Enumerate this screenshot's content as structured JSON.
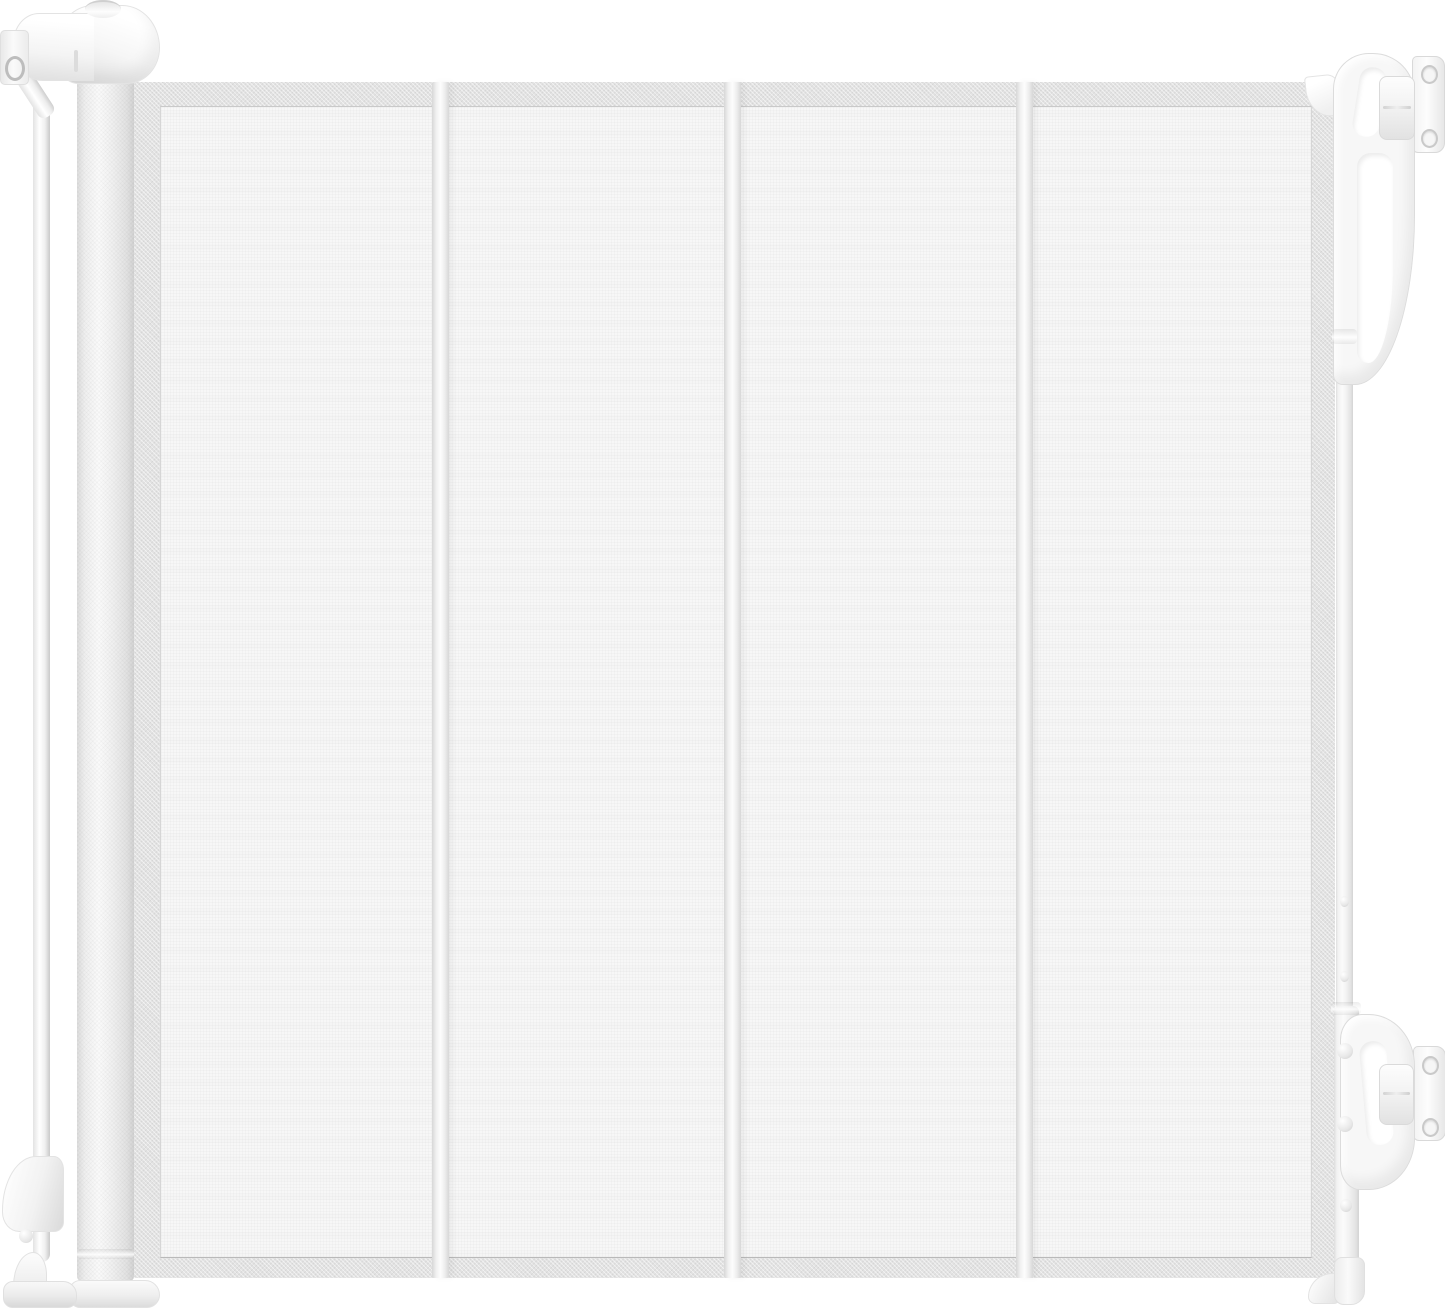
{
  "image": {
    "type": "product-photo",
    "subject": "white retractable mesh baby/pet safety gate, extended",
    "width_px": 1445,
    "height_px": 1309
  },
  "palette": {
    "background": "#ffffff",
    "mesh_fill": "#f7f7f7",
    "mesh_band": "#e2e2e2",
    "seam_light": "#fdfdfd",
    "seam_dark": "#d7d7d7",
    "hardware_white": "#fbfbfb",
    "hardware_mid": "#efefef",
    "hardware_shadow": "#d8d8d8",
    "outline": "#e0e0e0"
  },
  "components": {
    "mesh_panel": "retractable woven mesh screen with darker border band",
    "mesh_seam_count": 3,
    "roller_post": "spring-loaded roller housing with textured surface",
    "roller_cap": "rounded ratchet cap with oval top knob",
    "wall_clamp": "upper clamp block with screw hole",
    "tension_pole": "thin vertical tension pole",
    "pole_bracket": "lower pole wedge bracket with release knob",
    "pole_foot": "floor foot with base plate",
    "latch_bar": "vertical latch bar with screw bosses",
    "top_latch_handle": "upper carabiner-style locking handle",
    "bottom_latch_handle": "lower D-shaped locking handle",
    "wall_bracket_count": 2,
    "wall_bracket": "wall-mount plate with two screw holes",
    "bar_foot": "latch-bar floor foot with wedge"
  }
}
